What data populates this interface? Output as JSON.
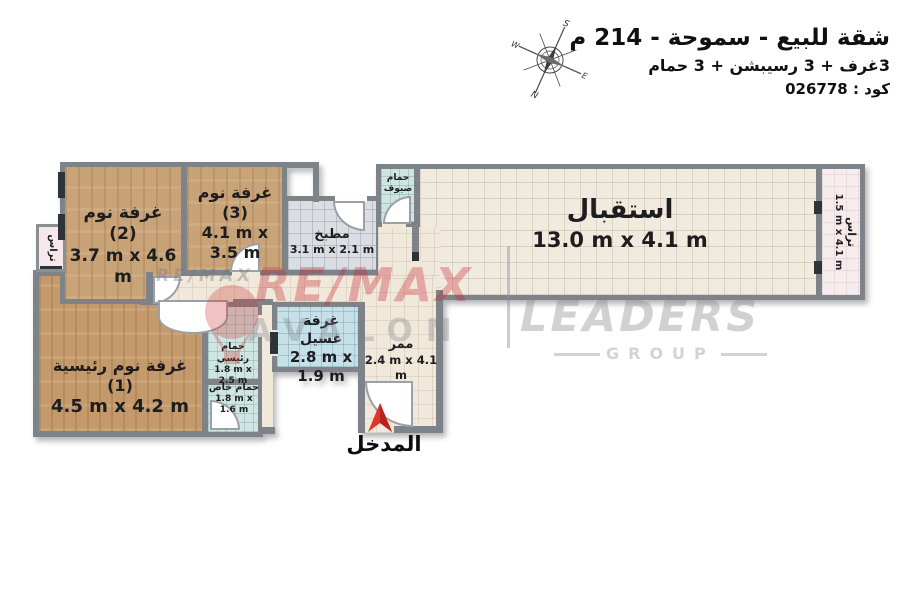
{
  "header": {
    "title": "شقة للبيع - سموحة - 214 م",
    "subtitle": "3غرف + 3 رسيبشن + 3 حمام",
    "code": "كود : 026778"
  },
  "compass": {
    "north": "N",
    "south": "S",
    "east": "E",
    "west": "W"
  },
  "rooms": {
    "bedroom2": {
      "name": "غرفة نوم (2)",
      "dims": "3.7 m x 4.6 m"
    },
    "bedroom3": {
      "name": "غرفة نوم (3)",
      "dims": "4.1 m x 3.5 m"
    },
    "kitchen": {
      "name": "مطبخ",
      "dims": "3.1 m x 2.1 m"
    },
    "guest_bath": {
      "name": "حمام ضيوف",
      "dims": ""
    },
    "reception": {
      "name": "استقبال",
      "dims": "13.0 m x 4.1 m"
    },
    "terrace_right": {
      "name": "تراس",
      "dims": "1.5 m x 4.1 m"
    },
    "terrace_left": {
      "name": "تراس",
      "dims": ""
    },
    "master_bedroom": {
      "name": "غرفة نوم رئيسية (1)",
      "dims": "4.5 m x 4.2 m"
    },
    "master_bath": {
      "name": "حمام رئيسي",
      "dims": "1.8 m x 2.5 m"
    },
    "private_bath": {
      "name": "حمام خاص",
      "dims": "1.8 m x 1.6 m"
    },
    "laundry": {
      "name": "غرفة غسيل",
      "dims": "2.8 m x 1.9 m"
    },
    "corridor": {
      "name": "ممر",
      "dims": "2.4 m x 4.1 m"
    }
  },
  "entrance": {
    "label": "المدخل"
  },
  "watermark": {
    "remax_small": "RE/MAX",
    "remax_large": "RE/MAX",
    "avalon": "AVALON",
    "leaders": "LEADERS",
    "group": "GROUP"
  },
  "colors": {
    "accent_red": "#e1342a",
    "watermark_red": "#c8202c",
    "wall_gray": "#7e838a",
    "wood_floor": "#c9a378",
    "wood_floor_master": "#c49a6c",
    "tile_cream": "#f1ebdf",
    "tile_kitchen": "#dadde1",
    "tile_bath": "#cfe5e1",
    "tile_laundry": "#c5e1e7",
    "tile_terrace": "#f6ecee"
  }
}
